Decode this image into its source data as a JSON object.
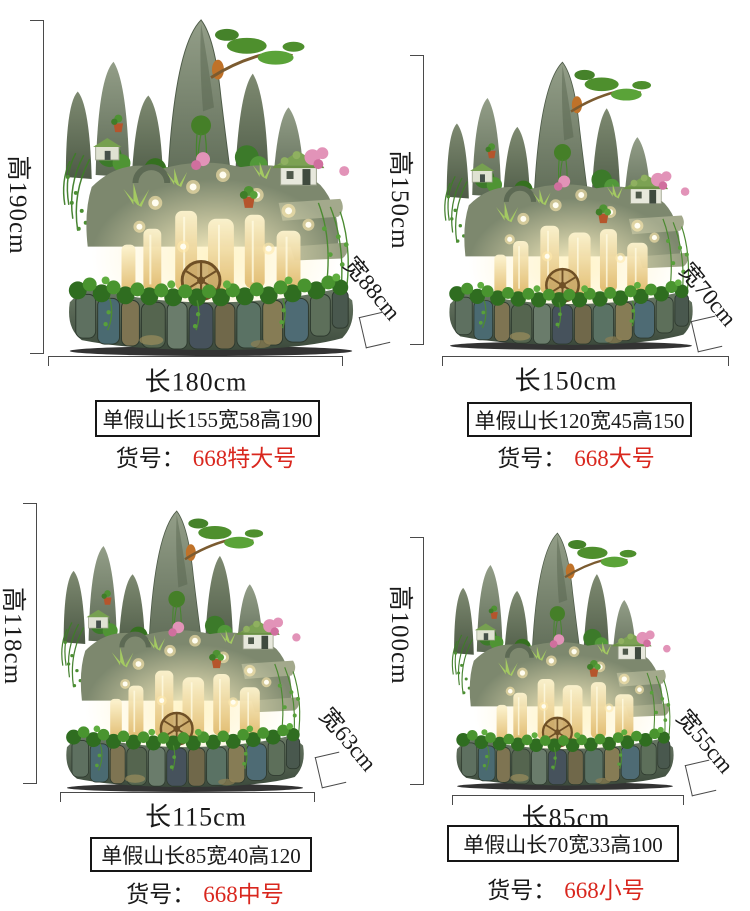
{
  "page": {
    "background": "#ffffff"
  },
  "colors": {
    "model_red": "#d9271e",
    "dimension_line": "#4a4a4a",
    "text": "#1a1a1a"
  },
  "model_prefix": "货号：",
  "products": [
    {
      "height_label": "高190cm",
      "width_label": "宽88cm",
      "length_label": "长180cm",
      "spec": "单假山长155宽58高190",
      "model": "668特大号"
    },
    {
      "height_label": "高150cm",
      "width_label": "宽70cm",
      "length_label": "长150cm",
      "spec": "单假山长120宽45高150",
      "model": "668大号"
    },
    {
      "height_label": "高118cm",
      "width_label": "宽63cm",
      "length_label": "长115cm",
      "spec": "单假山长85宽40高120",
      "model": "668中号"
    },
    {
      "height_label": "高100cm",
      "width_label": "宽55cm",
      "length_label": "长85cm",
      "spec": "单假山长70宽33高100",
      "model": "668小号"
    }
  ]
}
